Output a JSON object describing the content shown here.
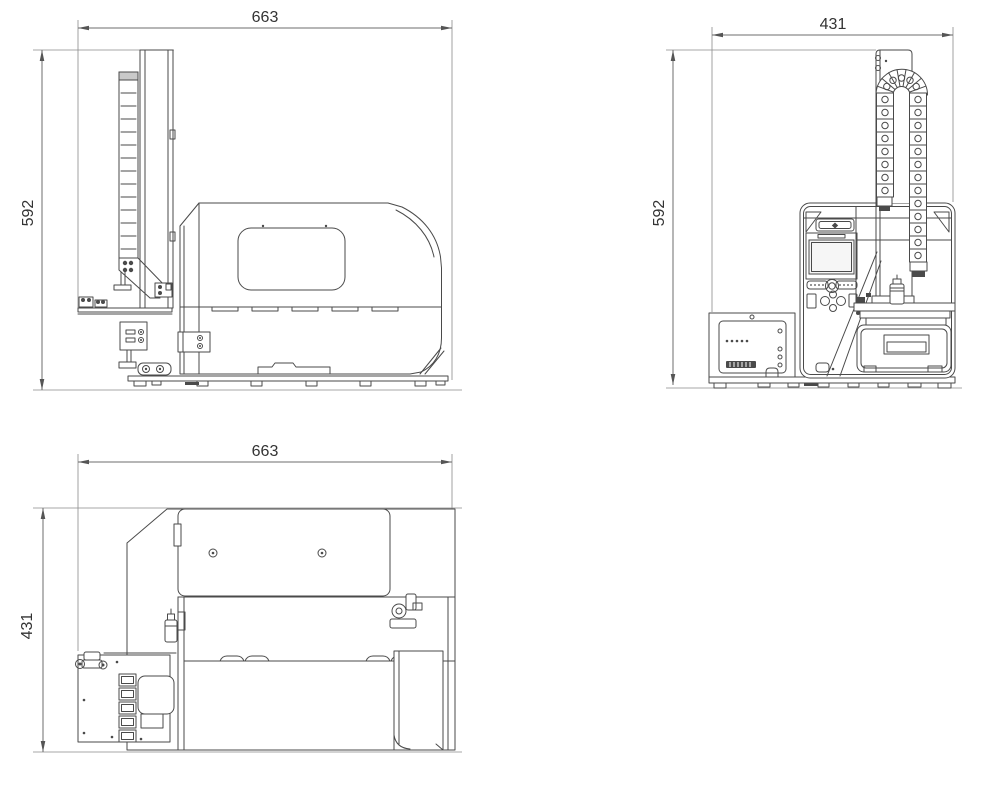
{
  "drawing": {
    "type": "technical-orthographic-views",
    "views": {
      "side": {
        "width_label": "663",
        "height_label": "592"
      },
      "front": {
        "width_label": "431",
        "height_label": "592"
      },
      "top": {
        "width_label": "663",
        "height_label": "431"
      }
    },
    "colors": {
      "background": "#ffffff",
      "machine_line": "#4a4a4a",
      "dimension_line": "#6e6e6e",
      "label_text": "#333333"
    }
  }
}
